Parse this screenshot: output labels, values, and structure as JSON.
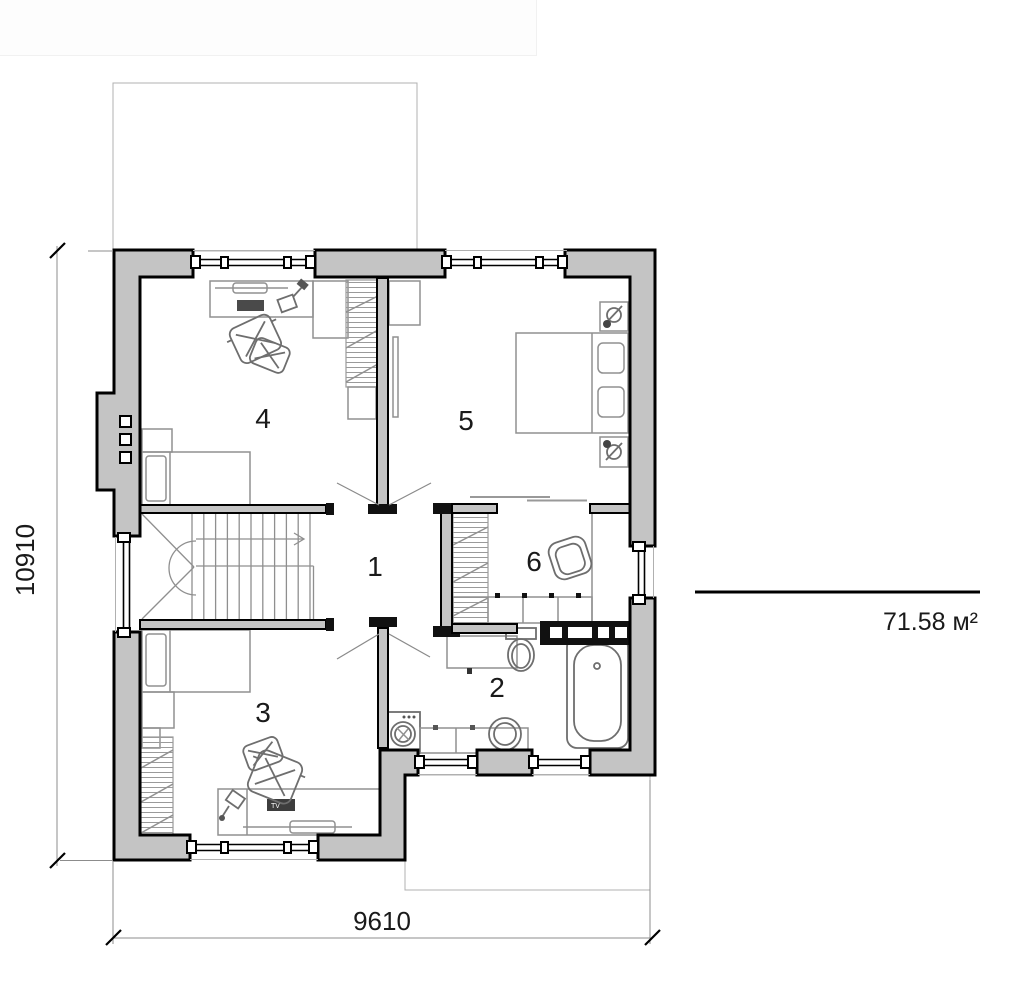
{
  "plan": {
    "rooms": [
      {
        "label": "1"
      },
      {
        "label": "2"
      },
      {
        "label": "3"
      },
      {
        "label": "4"
      },
      {
        "label": "5"
      },
      {
        "label": "6"
      }
    ],
    "dimensions": {
      "height_mm": "10910",
      "width_mm": "9610"
    },
    "area": {
      "total": "71.58 м²"
    },
    "furniture": {
      "tv_label": "TV"
    },
    "colors": {
      "wall_fill": "#c4c4c4",
      "outline": "#000000",
      "furniture_stroke": "#909090",
      "dimension_line": "#8c8c8c"
    }
  }
}
